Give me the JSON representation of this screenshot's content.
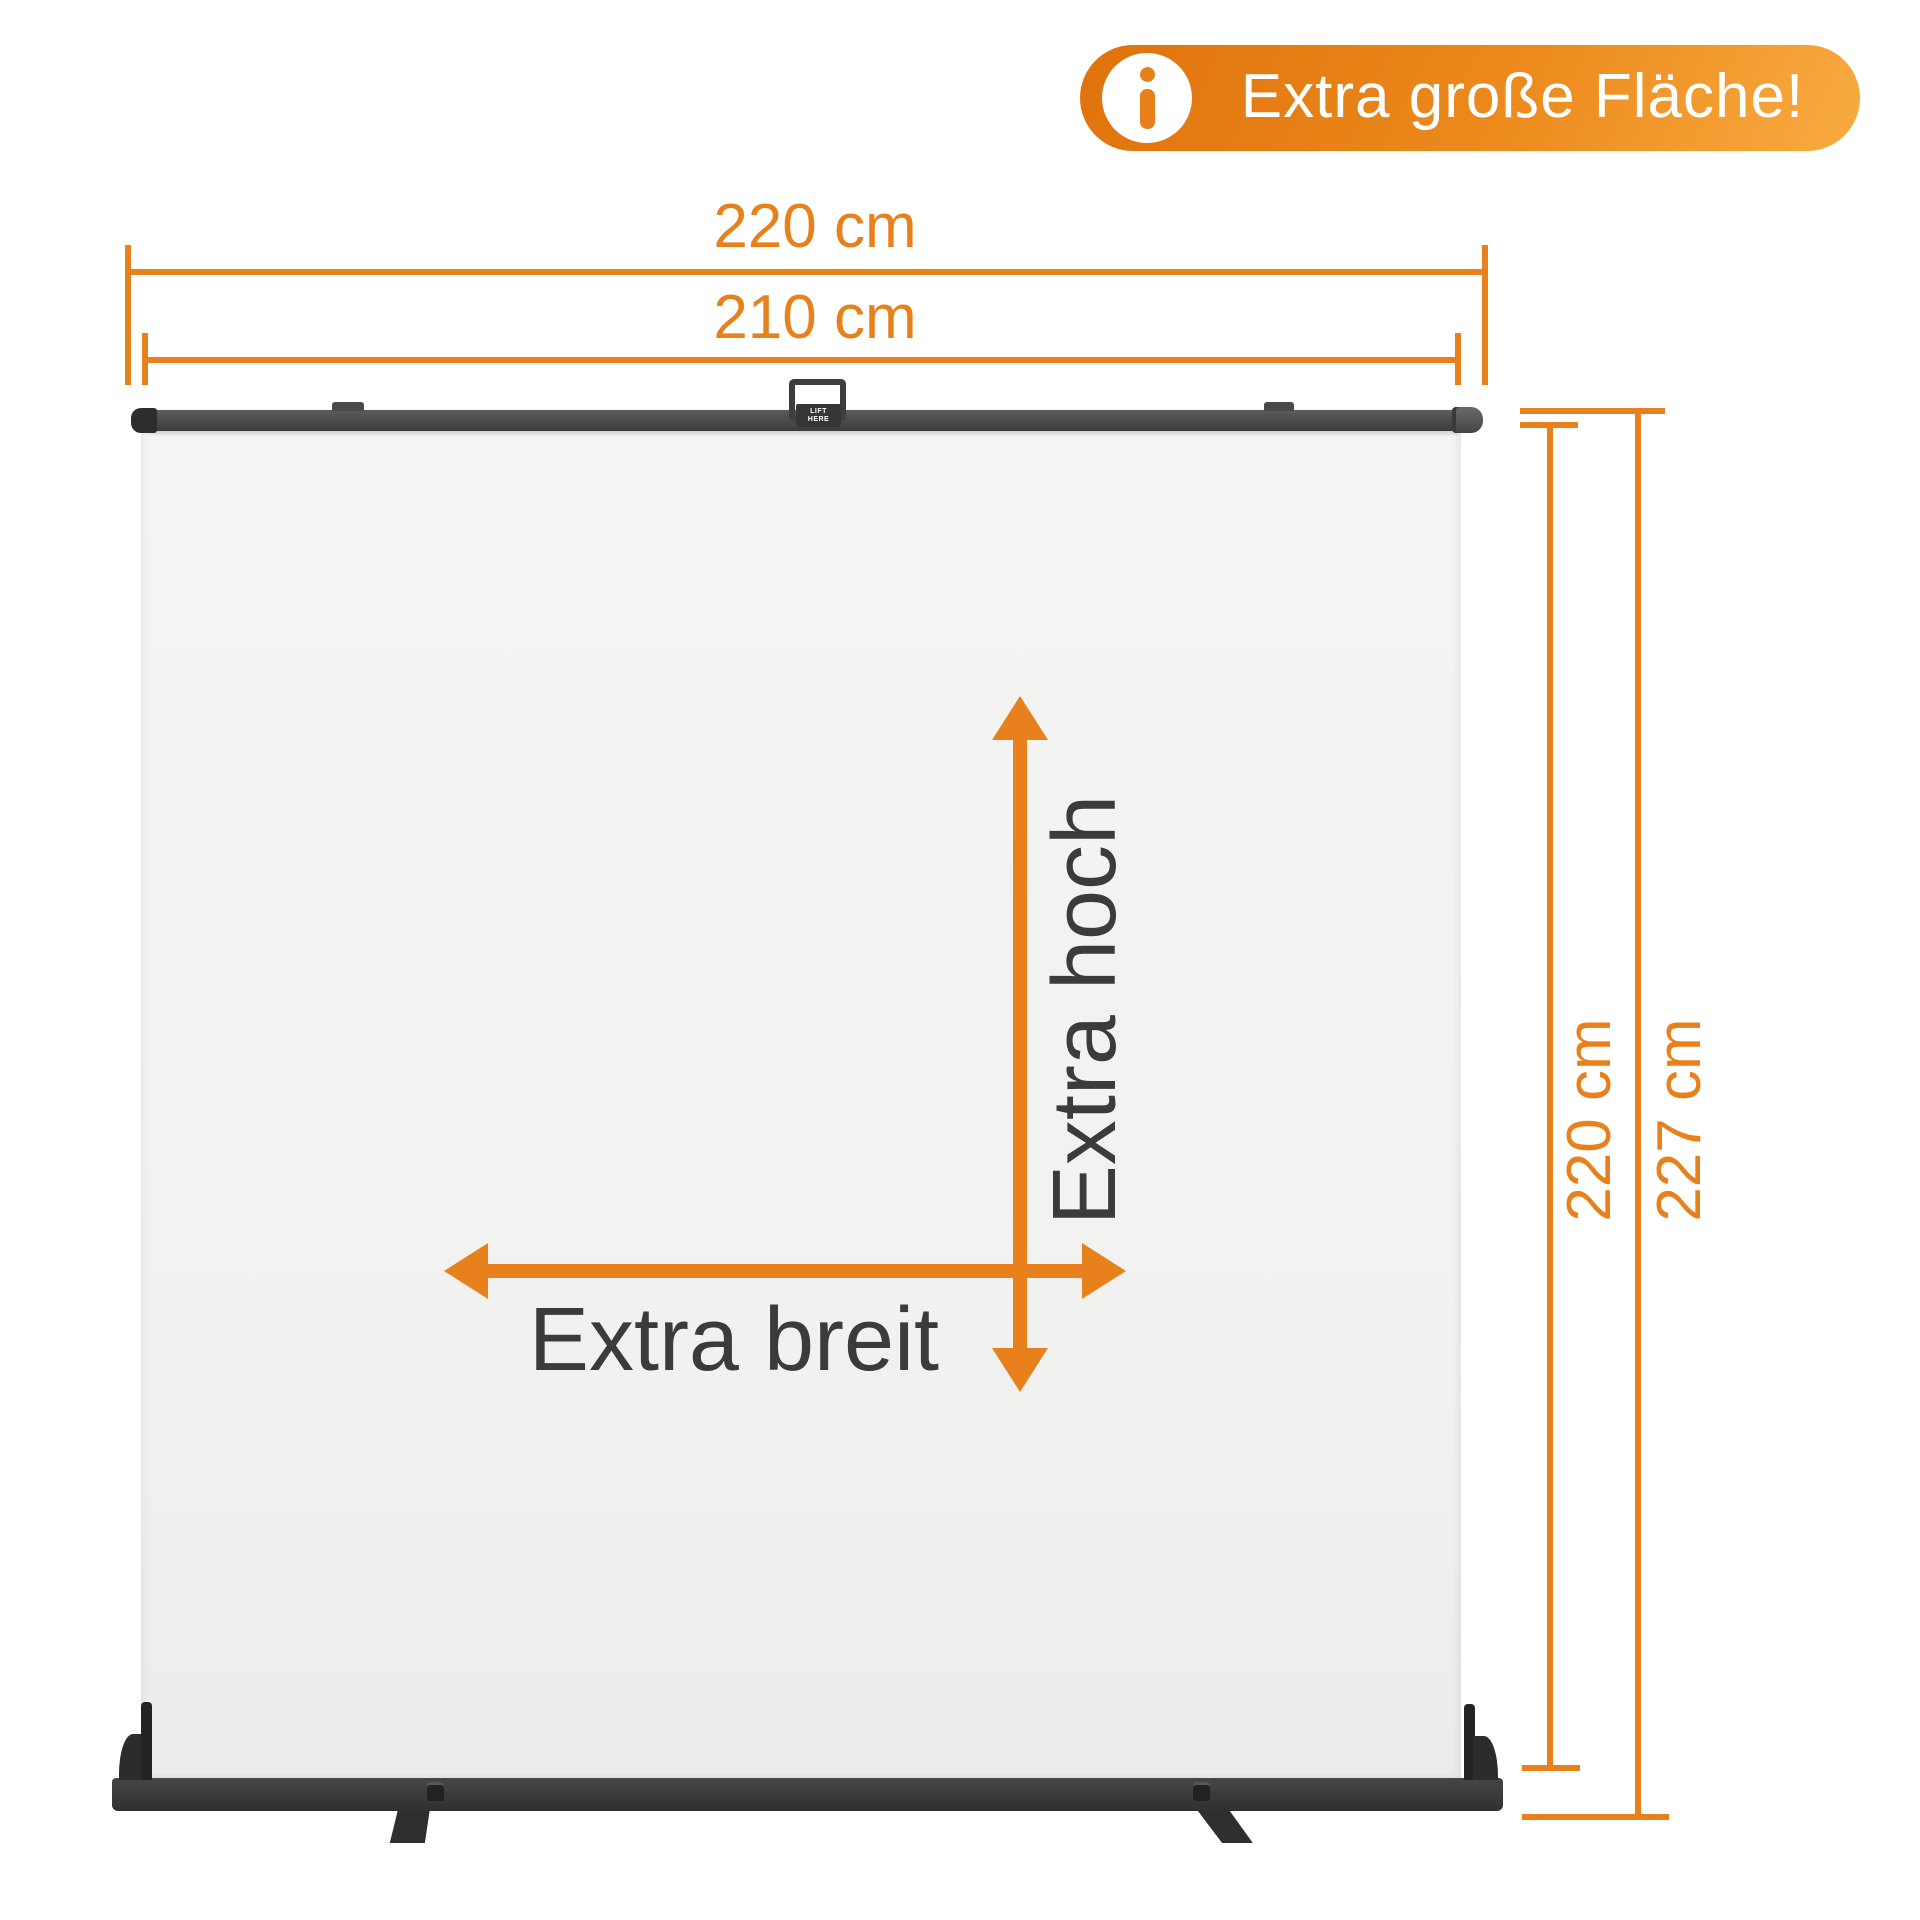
{
  "badge": {
    "label": "Extra große Fläche!",
    "icon": "info-icon"
  },
  "dimensions": {
    "top": [
      {
        "id": "total-width",
        "label": "220 cm"
      },
      {
        "id": "screen-width",
        "label": "210 cm"
      }
    ],
    "right": [
      {
        "id": "screen-height",
        "label": "220 cm"
      },
      {
        "id": "total-height",
        "label": "227 cm"
      }
    ]
  },
  "annotations": {
    "height": "Extra hoch",
    "width": "Extra breit"
  },
  "product": {
    "handle_label_line1": "LIFT",
    "handle_label_line2": "HERE"
  },
  "colors": {
    "accent_orange": "#E8811C",
    "badge_gradient_start": "#E0720C",
    "badge_gradient_end": "#F8AB40",
    "dark_text": "#3B3B3A",
    "frame_dark": "#3A3A3A",
    "panel_light": "#F3F3F1"
  }
}
